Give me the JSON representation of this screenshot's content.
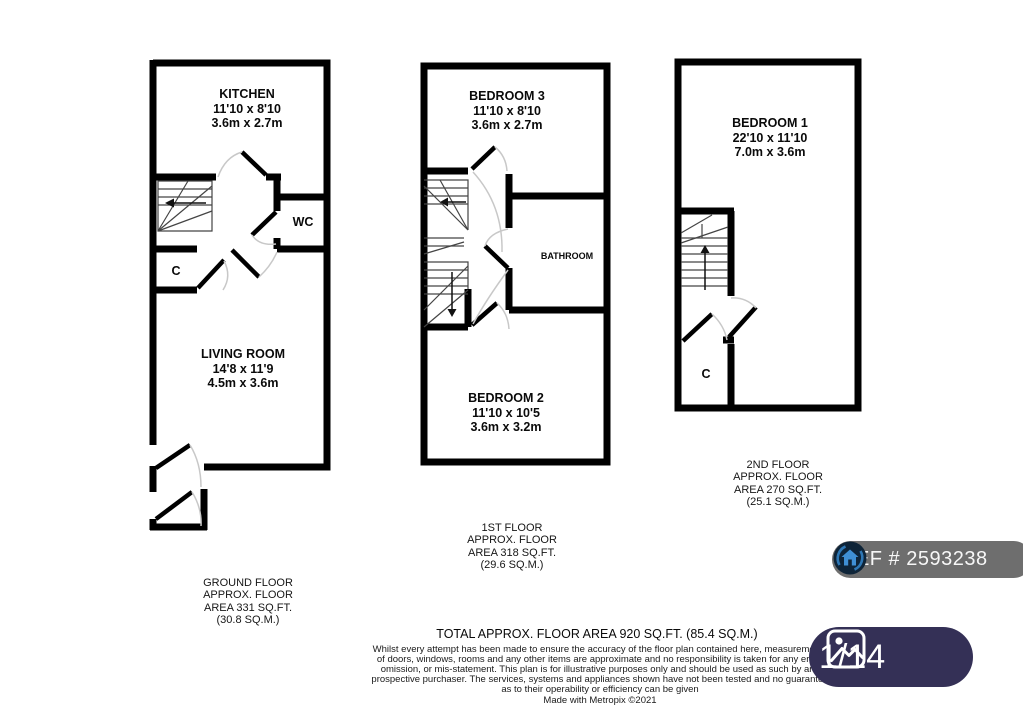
{
  "plans": {
    "ground": {
      "rooms": {
        "kitchen": {
          "name": "KITCHEN",
          "imperial": "11'10 x 8'10",
          "metric": "3.6m x 2.7m"
        },
        "wc": {
          "name": "WC"
        },
        "cupboard": {
          "name": "C"
        },
        "living": {
          "name": "LIVING ROOM",
          "imperial": "14'8 x 11'9",
          "metric": "4.5m x 3.6m"
        }
      },
      "label": {
        "l1": "GROUND FLOOR",
        "l2": "APPROX. FLOOR",
        "l3": "AREA 331 SQ.FT.",
        "l4": "(30.8 SQ.M.)"
      }
    },
    "first": {
      "rooms": {
        "bedroom3": {
          "name": "BEDROOM 3",
          "imperial": "11'10 x 8'10",
          "metric": "3.6m x 2.7m"
        },
        "bathroom": {
          "name": "BATHROOM"
        },
        "bedroom2": {
          "name": "BEDROOM 2",
          "imperial": "11'10 x 10'5",
          "metric": "3.6m x 3.2m"
        }
      },
      "label": {
        "l1": "1ST FLOOR",
        "l2": "APPROX. FLOOR",
        "l3": "AREA 318 SQ.FT.",
        "l4": "(29.6 SQ.M.)"
      }
    },
    "second": {
      "rooms": {
        "bedroom1": {
          "name": "BEDROOM 1",
          "imperial": "22'10 x 11'10",
          "metric": "7.0m x 3.6m"
        },
        "cupboard": {
          "name": "C"
        }
      },
      "label": {
        "l1": "2ND FLOOR",
        "l2": "APPROX. FLOOR",
        "l3": "AREA 270 SQ.FT.",
        "l4": "(25.1 SQ.M.)"
      }
    }
  },
  "footer": {
    "total": "TOTAL APPROX. FLOOR AREA 920 SQ.FT. (85.4 SQ.M.)",
    "disclaimer": [
      "Whilst every attempt has been made to ensure the accuracy of the floor plan contained here, measurements",
      "of doors, windows, rooms and any other items are approximate and no responsibility is taken for any error,",
      "omission, or mis-statement. This plan is for illustrative purposes only and should be used as such by any",
      "prospective purchaser. The services, systems and appliances shown have not been tested and no guarantee",
      "as to their operability or efficiency can be given",
      "Made with Metropix ©2021"
    ]
  },
  "overlays": {
    "ref_badge": {
      "label": "REF # 2593238",
      "icon": "house-circle-icon"
    },
    "photo_counter": {
      "label": "1/14",
      "icon": "photo-icon"
    }
  },
  "colors": {
    "wall": "#000000",
    "door_arc": "#c8c8c8",
    "stair_line": "#444444",
    "ref_badge_bg": "#6e6e6e",
    "counter_badge_bg": "#343056",
    "badge_text": "#ffffff",
    "logo_blue": "#3f8fd4"
  }
}
